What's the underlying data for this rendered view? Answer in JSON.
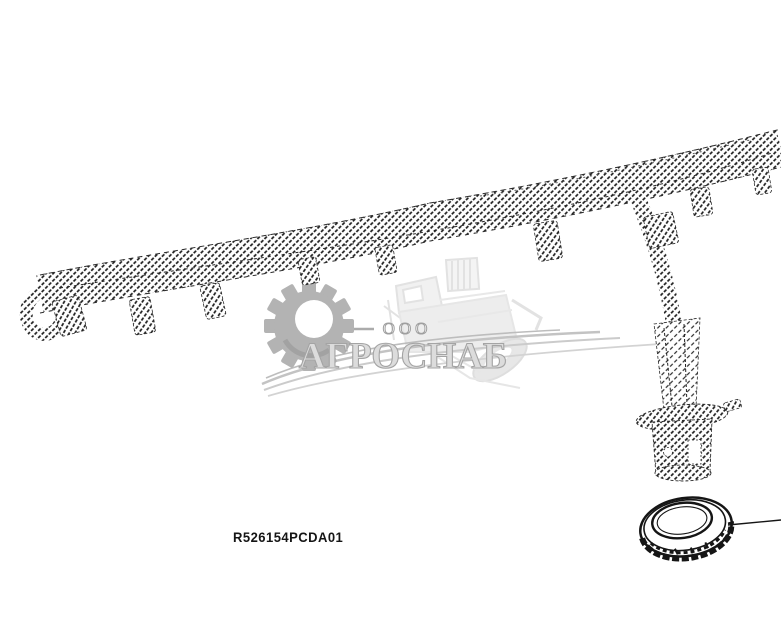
{
  "figure": {
    "part_number": "R526154PCDA01",
    "description": "wiring harness diagram with grommet seal callout"
  },
  "watermark": {
    "org_type": "ООО",
    "company_name": "АГРОСНАБ"
  },
  "colors": {
    "drawing_line": "#1a1a1a",
    "watermark_gray": "#b3b3b3",
    "watermark_text_fill": "#dcdcdc",
    "watermark_text_stroke": "#a4a4a4",
    "watermark_faint": "#e4e4e4",
    "background": "#ffffff"
  }
}
